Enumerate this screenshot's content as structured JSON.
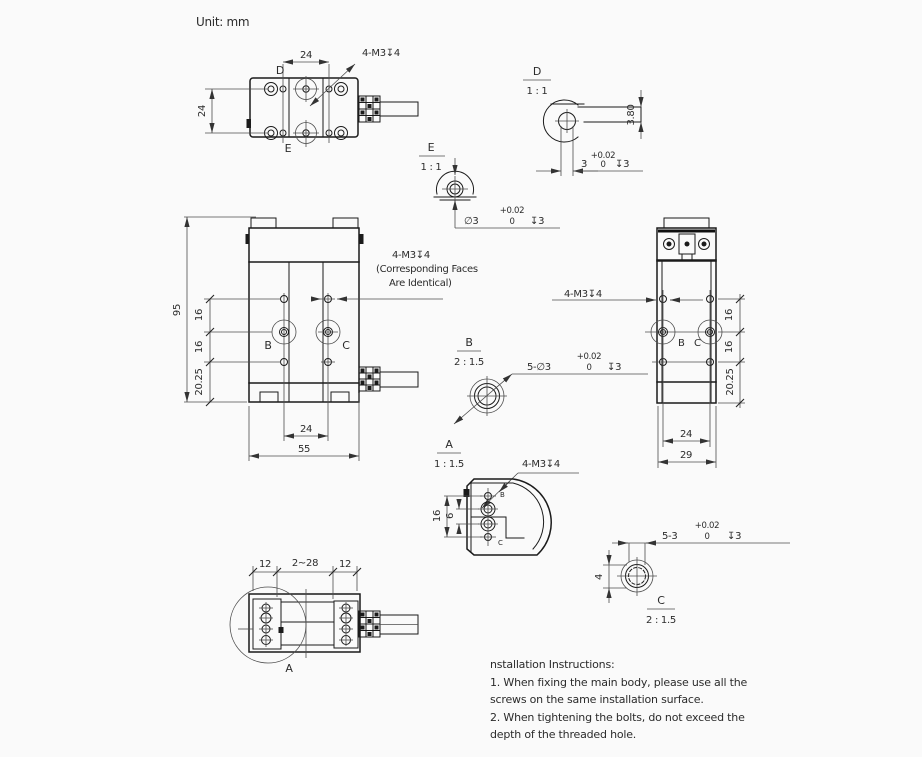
{
  "unit_label": "Unit: mm",
  "top_view": {
    "dim_width": "24",
    "dim_height": "24",
    "callout": "4-M3↧4",
    "label_d": "D",
    "label_e": "E"
  },
  "detail_d": {
    "label": "D",
    "scale": "1 : 1",
    "dim_thickness": "3.80",
    "dim_width": "3",
    "tol_plus": "+0.02",
    "tol_zero": "0",
    "depth": "↧3"
  },
  "detail_e": {
    "label": "E",
    "scale": "1 : 1",
    "dim_hole": "∅3",
    "tol_plus": "+0.02",
    "tol_zero": "0",
    "depth": "↧3"
  },
  "front_view": {
    "dim_height": "95",
    "dim_pitch1": "16",
    "dim_pitch2": "16",
    "dim_offset": "20.25",
    "dim_holes": "24",
    "dim_width": "55",
    "label_b": "B",
    "label_c": "C",
    "callout_line1": "4-M3↧4",
    "callout_line2": "(Corresponding Faces",
    "callout_line3": "Are Identical)"
  },
  "detail_b": {
    "label": "B",
    "scale": "2 : 1.5",
    "callout": "5-∅3",
    "tol_plus": "+0.02",
    "tol_zero": "0",
    "depth": "↧3"
  },
  "side_view": {
    "callout": "4-M3↧4",
    "dim_pitch1": "16",
    "dim_pitch2": "16",
    "dim_offset": "20.25",
    "dim_holes": "24",
    "dim_width": "29",
    "label_b": "B",
    "label_c": "C"
  },
  "detail_a": {
    "label": "A",
    "scale": "1 : 1.5",
    "callout": "4-M3↧4",
    "dim_16": "16",
    "dim_6": "6",
    "label_b": "B",
    "label_c": "C"
  },
  "bottom_view": {
    "dim_left": "12",
    "dim_range": "2~28",
    "dim_right": "12",
    "label_a": "A"
  },
  "detail_c": {
    "label": "C",
    "scale": "2 : 1.5",
    "callout": "5-3",
    "tol_plus": "+0.02",
    "tol_zero": "0",
    "depth": "↧3",
    "dim_4": "4"
  },
  "notes": {
    "title": "nstallation Instructions:",
    "line1": "1. When fixing the main body, please use all the",
    "line2": "screws on the same installation surface.",
    "line3": "2. When tightening the bolts, do not exceed the",
    "line4": "depth of the threaded hole."
  },
  "colors": {
    "background": "#fafafa",
    "ink": "#1b1b1b",
    "dim": "#4d4d4d"
  }
}
